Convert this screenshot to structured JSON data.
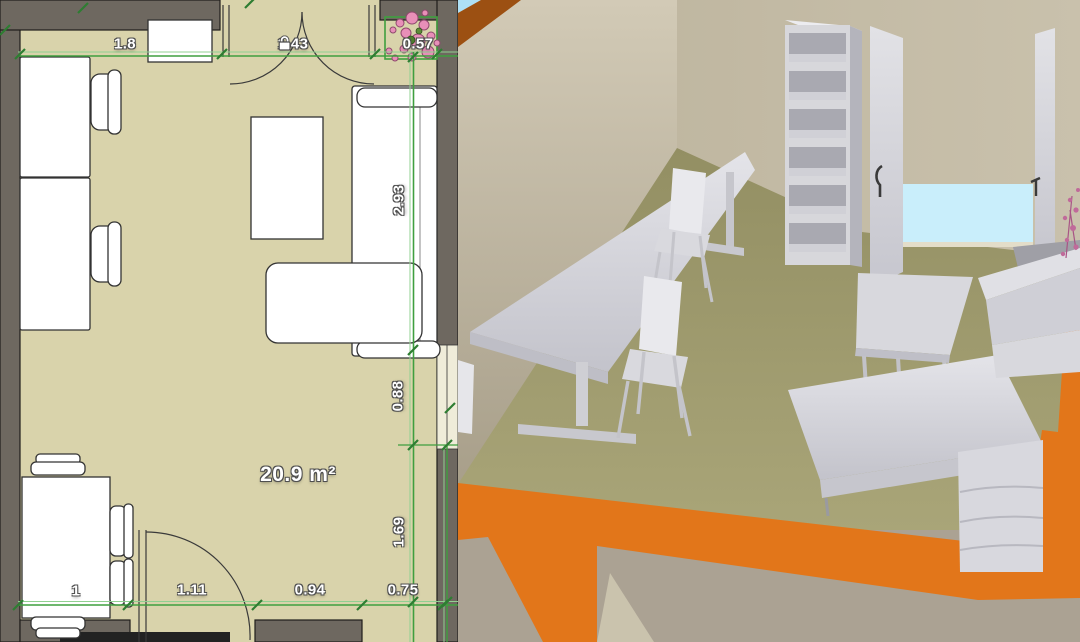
{
  "app": {
    "view": "floor-plan editor split view (2D plan + 3D aerial view)"
  },
  "plan": {
    "area_label": "20.9 m²",
    "dim_top": [
      "1.8",
      "1.43",
      "0.57"
    ],
    "dim_right": [
      "2.93",
      "0.88",
      "1.69"
    ],
    "dim_bottom": [
      "1",
      "1.11",
      "0.94",
      "0.75"
    ],
    "icons": {
      "lock": "lock-icon (padlock on locked door dimension)"
    },
    "colors": {
      "floor": "#d9d3ab",
      "wall": "#6e6860",
      "wall_outline": "#1f1d1a",
      "dimension_green": "#3f9f3f",
      "dimension_green_light": "#90d090",
      "tick_green": "#2e7d32",
      "furniture_fill": "#ffffff",
      "furniture_outline": "#333333",
      "plant_pink": "#e88fb8",
      "plant_outline": "#8f4a6e",
      "selection_green": "#3f9f3f"
    }
  },
  "view3d": {
    "colors": {
      "back_wall": "#c5bda6",
      "left_wall_top": "#d2cab6",
      "left_wall_bottom": "#a89f8a",
      "floor_back": "#938f63",
      "floor_front": "#aaa679",
      "outside_floor": "#aba293",
      "outside_floor_light": "#cac3ad",
      "wall_cut_orange": "#e2761a",
      "wall_cut_brown": "#9c5012",
      "sky_blue": "#aee0f5",
      "glass_blue": "#c9eefb",
      "furniture_light": "#e2e2e7",
      "furniture_mid": "#cfcfd6",
      "furniture_dark": "#aaaab2",
      "handle_dark": "#3a3a3a",
      "plant_pink": "#c06a9a"
    }
  }
}
